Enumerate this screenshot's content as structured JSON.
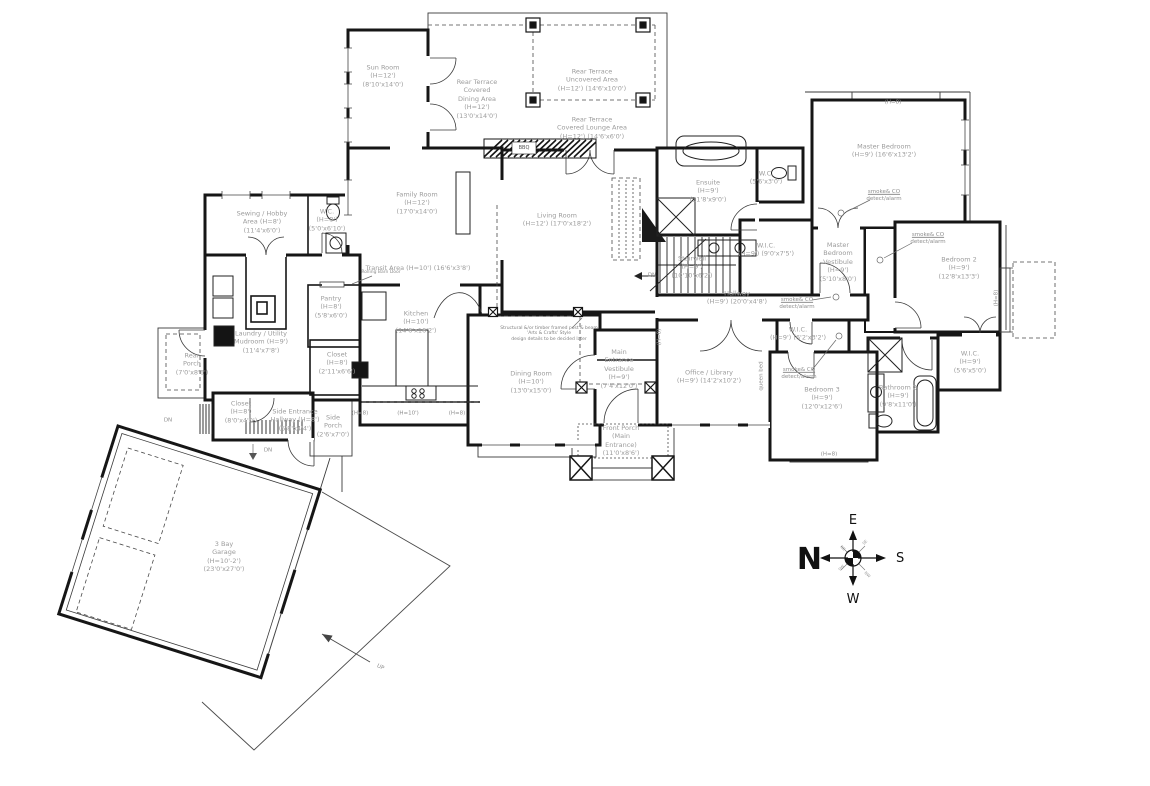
{
  "rooms": {
    "sunroom": {
      "lines": [
        "Sun Room",
        "(H=12')",
        "(8'10'x14'0')"
      ]
    },
    "terrace_dining": {
      "lines": [
        "Rear Terrace",
        "Covered",
        "Dining Area",
        "(H=12')",
        "(13'0'x14'0')"
      ]
    },
    "terrace_uncovered": {
      "lines": [
        "Rear Terrace",
        "Uncovered Area",
        "(H=12')  (14'6'x10'0')"
      ]
    },
    "terrace_lounge": {
      "lines": [
        "Rear Terrace",
        "Covered Lounge Area",
        "(H=12')  (14'6'x6'0')"
      ]
    },
    "family_room": {
      "lines": [
        "Family Room",
        "(H=12')",
        "(17'0'x14'0')"
      ]
    },
    "living_room": {
      "lines": [
        "Living Room",
        "(H=12')  (17'0'x18'2')"
      ]
    },
    "sewing": {
      "lines": [
        "Sewing / Hobby",
        "Area (H=8')",
        "(11'4'x6'0')"
      ]
    },
    "wc_main": {
      "lines": [
        "W.C.",
        "(H=8')",
        "(5'0'x6'10')"
      ]
    },
    "transit": {
      "lines": [
        "Transit Area  (H=10')  (16'6'x3'8')"
      ]
    },
    "pantry": {
      "lines": [
        "Pantry",
        "(H=8')",
        "(5'8'x6'0')"
      ]
    },
    "kitchen": {
      "lines": [
        "Kitchen",
        "(H=10')",
        "(14'6'x16'2')"
      ]
    },
    "laundry": {
      "lines": [
        "Laundry / Utility",
        "Mudroom (H=9')",
        "(11'4'x7'8')"
      ]
    },
    "rear_porch": {
      "lines": [
        "Rear",
        "Porch",
        "(7'0'x8'6')"
      ]
    },
    "closet_rear": {
      "lines": [
        "Closet",
        "(H=8')",
        "(8'0'x4'0')"
      ]
    },
    "side_hallway": {
      "lines": [
        "Side Entrance",
        "Hallway (H=8')",
        "(5'8'x4'4')"
      ]
    },
    "side_porch": {
      "lines": [
        "Side",
        "Porch",
        "(2'6'x7'0')"
      ]
    },
    "closet_kitchen": {
      "lines": [
        "Closet",
        "(H=8')",
        "(2'11'x6'6')"
      ]
    },
    "dining_room": {
      "lines": [
        "Dining Room",
        "(H=10')",
        "(13'0'x15'0')"
      ]
    },
    "main_vestibule": {
      "lines": [
        "Main",
        "Entrance",
        "Vestibule",
        "(H=9')",
        "(7'4'x12'0')"
      ]
    },
    "front_porch": {
      "lines": [
        "Front Porch",
        "(Main",
        "Entrance)",
        "(11'0'x8'6')"
      ]
    },
    "ensuite": {
      "lines": [
        "Ensuite",
        "(H=9')",
        "(11'8'x9'0')"
      ]
    },
    "ensuite_wc": {
      "lines": [
        "W.C.",
        "(5'6'x3'0')"
      ]
    },
    "stairwell": {
      "lines": [
        "Stairwell",
        "(H=9')",
        "(10'10'x6'2')"
      ]
    },
    "master_wic": {
      "lines": [
        "W.I.C.",
        "(H=9')  (9'0'x7'5')"
      ]
    },
    "hallway": {
      "lines": [
        "Hallway",
        "(H=9')  (20'0'x4'8')"
      ]
    },
    "master_bedroom": {
      "lines": [
        "Master Bedroom",
        "(H=9')  (16'6'x13'2')"
      ]
    },
    "master_vestibule": {
      "lines": [
        "Master",
        "Bedroom",
        "Vestibule",
        "(H=9')",
        "(5'10'x8'0')"
      ]
    },
    "bedroom2": {
      "lines": [
        "Bedroom 2",
        "(H=9')",
        "(12'8'x13'3')"
      ]
    },
    "bedroom2_wic": {
      "lines": [
        "W.I.C.",
        "(H=9')",
        "(5'6'x5'0')"
      ]
    },
    "bathroom2": {
      "lines": [
        "Bathroom 2",
        "(H=9')",
        "(9'8'x11'0')"
      ]
    },
    "office": {
      "lines": [
        "Office / Library",
        "(H=9')  (14'2'x10'2')"
      ]
    },
    "bedroom3_wic": {
      "lines": [
        "W.I.C.",
        "(H=9')  (6'2'x3'2')"
      ]
    },
    "bedroom3": {
      "lines": [
        "Bedroom 3",
        "(H=9')",
        "(12'0'x12'6')"
      ]
    },
    "garage": {
      "lines": [
        "3 Bay",
        "Garage",
        "(H=10'-2')",
        "(23'0'x27'0')"
      ]
    }
  },
  "annotations": {
    "smoke_co": {
      "line1": "smoke& CO",
      "line2": "detect/alarm"
    },
    "bbq": "BBQ",
    "queen_bed": "queen bed",
    "barn_door": "Rolling Barn Door",
    "note": {
      "line1": "Structural &/or timber framed post & beam",
      "line2": "'Arts & Crafts' Style",
      "line3": "design details to be decided later"
    },
    "dn": "DN",
    "up": "UP",
    "h8": "(H=8)",
    "h10": "(H=10')"
  },
  "compass": {
    "n": "N",
    "e": "E",
    "s": "S",
    "w": "W",
    "ne": "NE",
    "se": "SE",
    "sw": "SW",
    "nw": "NW"
  }
}
